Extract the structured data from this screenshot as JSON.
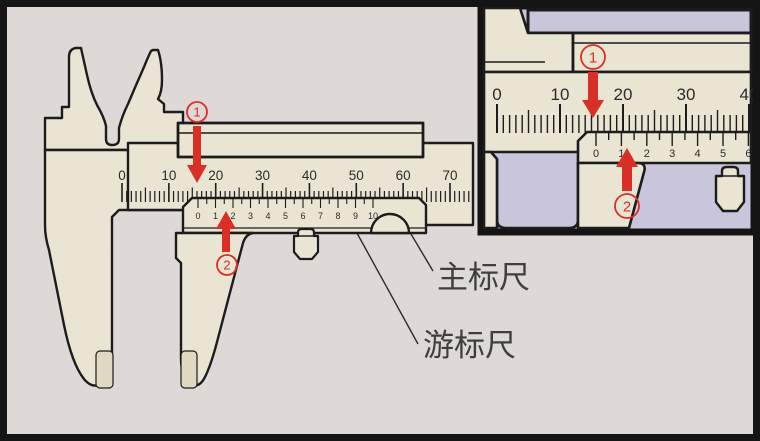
{
  "title": "Vernier caliper reading illustration",
  "colors": {
    "background": "#ded9d6",
    "caliper_body": "#eae4d2",
    "caliper_shade": "#e0d9c1",
    "inset_background": "#c9c6db",
    "outline": "#1c1c1c",
    "accent_red": "#d92f27",
    "label_text": "#3f3f3f",
    "frame_black": "#141414",
    "scale_text": "#2b2b2b"
  },
  "main_view": {
    "main_scale": {
      "numbers": [
        "0",
        "10",
        "20",
        "30",
        "40",
        "50",
        "60",
        "70"
      ]
    },
    "vernier_scale": {
      "numbers": [
        "0",
        "1",
        "2",
        "3",
        "4",
        "5",
        "6",
        "7",
        "8",
        "9",
        "10"
      ]
    },
    "markers": [
      {
        "number": "1"
      },
      {
        "number": "2"
      }
    ]
  },
  "inset_view": {
    "main_scale": {
      "numbers": [
        "0",
        "10",
        "20",
        "30",
        "40"
      ]
    },
    "vernier_scale": {
      "numbers": [
        "0",
        "1",
        "2",
        "3",
        "4",
        "5",
        "6"
      ]
    },
    "markers": [
      {
        "number": "1"
      },
      {
        "number": "2"
      }
    ]
  },
  "callouts": {
    "main_scale": "主标尺",
    "vernier_scale": "游标尺"
  }
}
